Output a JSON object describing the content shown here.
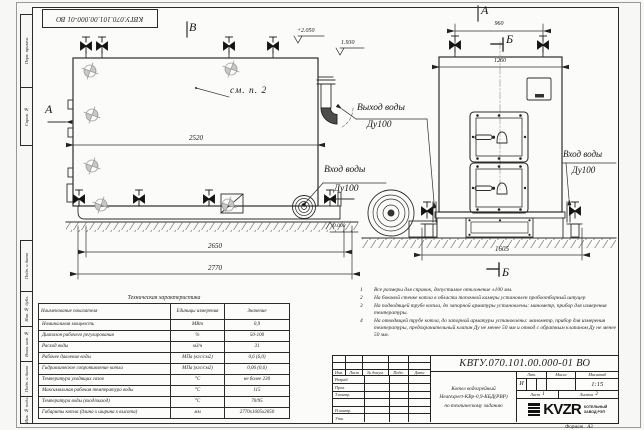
{
  "sheet": {
    "stamp_top": "КВТУ.070.101.00.000-01 ВО",
    "format_label": "Формат",
    "format_value": "А3",
    "margin_blocks": [
      "Перв. примен.",
      "Справ. №",
      "Подп. и дата",
      "Инв. № дубл.",
      "Взам. инв. №",
      "Подп. и дата",
      "Инв. № подл."
    ]
  },
  "drawing": {
    "view_labels": {
      "b_view": "В",
      "a_side": "А",
      "a_front": "А",
      "b_section_top": "Б",
      "b_section_bottom": "Б"
    },
    "annotations": {
      "see_note": "см. п. 2",
      "outlet_line1": "Выход воды",
      "outlet_line2": "Ду100",
      "inlet_left_line1": "Вход воды",
      "inlet_left_line2": "Ду100",
      "inlet_right_line1": "Вход воды",
      "inlet_right_line2": "Ду100"
    },
    "elevations": {
      "top": "+2.050",
      "outlet": "1.930",
      "ground": "0.000"
    },
    "dimensions": {
      "side_inner": "2520",
      "side_base": "2650",
      "side_total": "2770",
      "front_valves": "960",
      "front_width": "1260",
      "front_base": "1605"
    }
  },
  "spec_table": {
    "title": "Техническая характеристика",
    "headers": [
      "Наименование показателя",
      "Единицы измерения",
      "Значение"
    ],
    "rows": [
      [
        "Номинальная мощность",
        "МВт",
        "0,9"
      ],
      [
        "Диапазон рабочего регулирования",
        "%",
        "50-100"
      ],
      [
        "Расход воды",
        "м3/ч",
        "31"
      ],
      [
        "Рабочее давление воды",
        "МПа (кгс/см2)",
        "0,6 (6,0)"
      ],
      [
        "Гидравлическое сопротивление котла",
        "МПа (кгс/см2)",
        "0,06 (0,6)"
      ],
      [
        "Температура уходящих газов",
        "°С",
        "не более 230"
      ],
      [
        "Максимальная рабочая температура воды",
        "°С",
        "115"
      ],
      [
        "Температура воды (вход/выход)",
        "°С",
        "70/95"
      ],
      [
        "Габариты котла (длина х ширина х высота)",
        "мм",
        "2770х1605х2050"
      ]
    ]
  },
  "notes": [
    {
      "num": "1",
      "text": "Все размеры для справок, допустимое отклонение ±100 мм."
    },
    {
      "num": "2",
      "text": "На боковой стенке котла в области топочной камеры установлен пробоотборный штуцер"
    },
    {
      "num": "3",
      "text": "На подводящей трубе котла, до запорной арматуры установлены: манометр, прибор для измерения температуры."
    },
    {
      "num": "4",
      "text": "На отводящей трубе котла, до запорной арматуры установлены: манометр, прибор для измерения температуры, предохранительный клапан Ду не менее 50 мм и отвод с обратным клапаном Ду не менее 50 мм."
    }
  ],
  "title_block": {
    "doc_number": "КВТУ.070.101.00.000-01 ВО",
    "header_cols": [
      "Изм.",
      "Лист",
      "№ докум.",
      "Подп.",
      "Дата"
    ],
    "row_labels": [
      "Разраб.",
      "Пров.",
      "Т.контр.",
      "",
      "Н.контр.",
      "Утв."
    ],
    "title_lines": [
      "Котел водогрейный",
      "Heatexpert-КВр-0,9-КБД(РВР)",
      "по техническому заданию"
    ],
    "lit_label": "Лит.",
    "lit_value": "И",
    "mass_label": "Масса",
    "scale_label": "Масштаб",
    "scale_value": "1:15",
    "sheet_label": "Лист",
    "sheet_value": "1",
    "sheets_label": "Листов",
    "sheets_value": "2",
    "logo_text": "KVZR",
    "company_lines": [
      "КОТЕЛЬНЫЙ",
      "ЗАВОД РЭП"
    ]
  }
}
